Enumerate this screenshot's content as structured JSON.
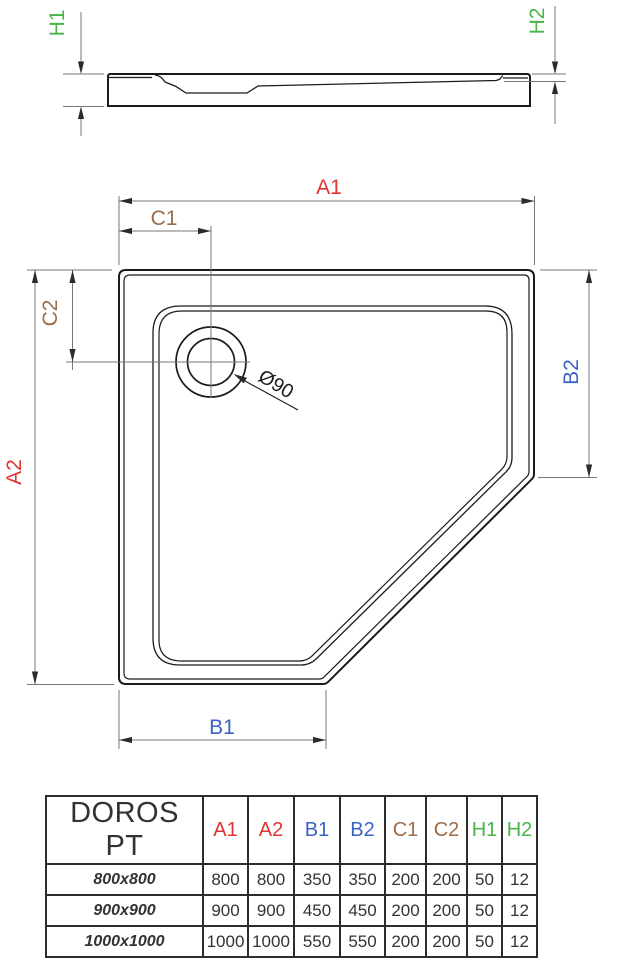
{
  "labels": {
    "h1": "H1",
    "h2": "H2",
    "a1": "A1",
    "a2": "A2",
    "b1": "B1",
    "b2": "B2",
    "c1": "C1",
    "c2": "C2",
    "drain_diameter": "Ø90"
  },
  "colors": {
    "red": "#e23333",
    "blue": "#3b63c4",
    "brown": "#9c6b47",
    "green": "#49b449",
    "outline": "#1b1b1b",
    "dim_line": "#777777",
    "arrow": "#2b2b2b"
  },
  "table": {
    "product_label": "DOROS PT",
    "columns": [
      {
        "label": "A1",
        "color": "#e23333"
      },
      {
        "label": "A2",
        "color": "#e23333"
      },
      {
        "label": "B1",
        "color": "#3b63c4"
      },
      {
        "label": "B2",
        "color": "#3b63c4"
      },
      {
        "label": "C1",
        "color": "#9c6b47"
      },
      {
        "label": "C2",
        "color": "#9c6b47"
      },
      {
        "label": "H1",
        "color": "#49b449"
      },
      {
        "label": "H2",
        "color": "#49b449"
      }
    ],
    "rows": [
      {
        "size": "800x800",
        "values": [
          "800",
          "800",
          "350",
          "350",
          "200",
          "200",
          "50",
          "12"
        ]
      },
      {
        "size": "900x900",
        "values": [
          "900",
          "900",
          "450",
          "450",
          "200",
          "200",
          "50",
          "12"
        ]
      },
      {
        "size": "1000x1000",
        "values": [
          "1000",
          "1000",
          "550",
          "550",
          "200",
          "200",
          "50",
          "12"
        ]
      }
    ]
  }
}
